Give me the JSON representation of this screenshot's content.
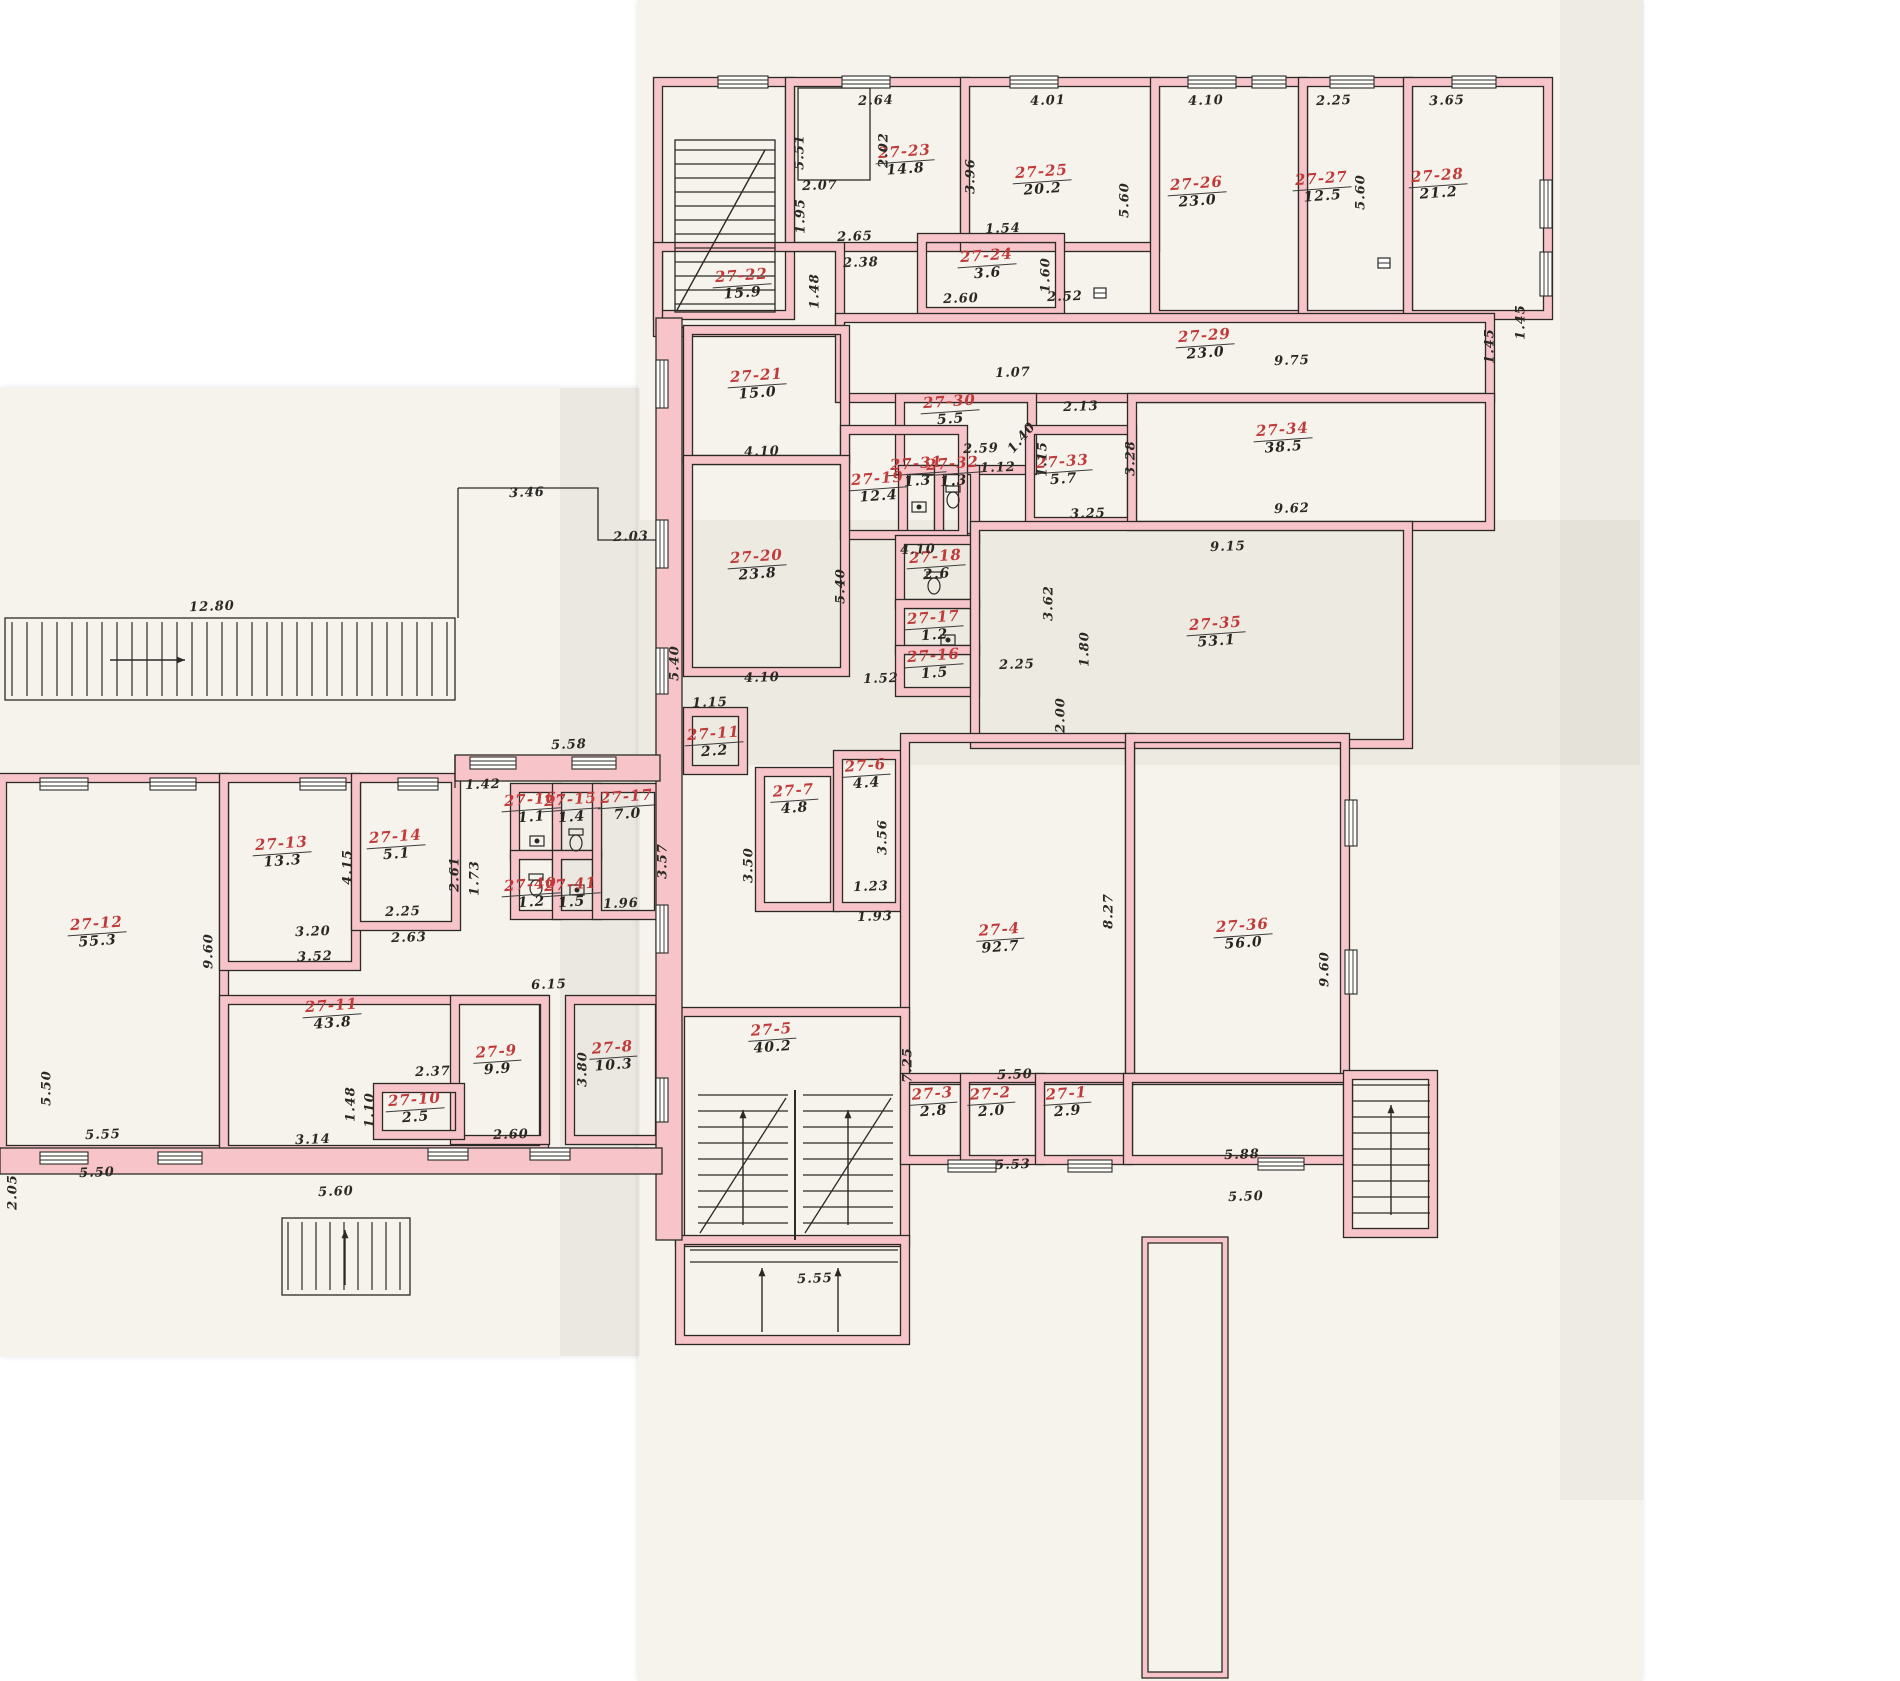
{
  "palette": {
    "paper": "#f6f3ec",
    "wall_pink": "#f6c4c9",
    "ink": "#2b2a26",
    "room_number_red": "#c13a3a"
  },
  "rooms": [
    {
      "id": "27-23",
      "area": "14.8",
      "x": 905,
      "y": 160
    },
    {
      "id": "27-25",
      "area": "20.2",
      "x": 1042,
      "y": 180
    },
    {
      "id": "27-26",
      "area": "23.0",
      "x": 1197,
      "y": 192
    },
    {
      "id": "27-27",
      "area": "12.5",
      "x": 1322,
      "y": 187
    },
    {
      "id": "27-28",
      "area": "21.2",
      "x": 1438,
      "y": 184
    },
    {
      "id": "27-22",
      "area": "15.9",
      "x": 742,
      "y": 284
    },
    {
      "id": "27-24",
      "area": "3.6",
      "x": 987,
      "y": 264
    },
    {
      "id": "27-29",
      "area": "23.0",
      "x": 1205,
      "y": 344
    },
    {
      "id": "27-21",
      "area": "15.0",
      "x": 757,
      "y": 384
    },
    {
      "id": "27-30",
      "area": "5.5",
      "x": 950,
      "y": 410
    },
    {
      "id": "27-31",
      "area": "1.3",
      "x": 917,
      "y": 472
    },
    {
      "id": "27-32",
      "area": "1.3",
      "x": 953,
      "y": 472
    },
    {
      "id": "27-33",
      "area": "5.7",
      "x": 1063,
      "y": 470
    },
    {
      "id": "27-34",
      "area": "38.5",
      "x": 1283,
      "y": 438
    },
    {
      "id": "27-19",
      "area": "12.4",
      "x": 878,
      "y": 487
    },
    {
      "id": "27-20",
      "area": "23.8",
      "x": 757,
      "y": 565
    },
    {
      "id": "27-18",
      "area": "2.6",
      "x": 936,
      "y": 565
    },
    {
      "id": "27-17",
      "area": "1.2",
      "x": 934,
      "y": 626
    },
    {
      "id": "27-16",
      "area": "1.5",
      "x": 934,
      "y": 664
    },
    {
      "id": "27-35",
      "area": "53.1",
      "x": 1216,
      "y": 632
    },
    {
      "id": "27-11",
      "area": "2.2",
      "x": 714,
      "y": 742
    },
    {
      "id": "27-6",
      "area": "4.4",
      "x": 866,
      "y": 774
    },
    {
      "id": "27-7",
      "area": "4.8",
      "x": 794,
      "y": 799
    },
    {
      "id": "27-4",
      "area": "92.7",
      "x": 1000,
      "y": 938
    },
    {
      "id": "27-36",
      "area": "56.0",
      "x": 1243,
      "y": 934
    },
    {
      "id": "27-5",
      "area": "40.2",
      "x": 772,
      "y": 1038
    },
    {
      "id": "27-3",
      "area": "2.8",
      "x": 933,
      "y": 1102
    },
    {
      "id": "27-2",
      "area": "2.0",
      "x": 991,
      "y": 1102
    },
    {
      "id": "27-1",
      "area": "2.9",
      "x": 1067,
      "y": 1102
    },
    {
      "id": "27-12",
      "area": "55.3",
      "x": 97,
      "y": 932
    },
    {
      "id": "27-13",
      "area": "13.3",
      "x": 282,
      "y": 852
    },
    {
      "id": "27-14",
      "area": "5.1",
      "x": 396,
      "y": 845
    },
    {
      "id": "27-16",
      "area": "1.1",
      "x": 531,
      "y": 808
    },
    {
      "id": "27-15",
      "area": "1.4",
      "x": 571,
      "y": 808
    },
    {
      "id": "27-17",
      "area": "7.0",
      "x": 627,
      "y": 805
    },
    {
      "id": "27-40",
      "area": "1.2",
      "x": 531,
      "y": 893
    },
    {
      "id": "27-41",
      "area": "1.5",
      "x": 571,
      "y": 893
    },
    {
      "id": "27-11",
      "area": "43.8",
      "x": 332,
      "y": 1014
    },
    {
      "id": "27-10",
      "area": "2.5",
      "x": 415,
      "y": 1108
    },
    {
      "id": "27-9",
      "area": "9.9",
      "x": 497,
      "y": 1060
    },
    {
      "id": "27-8",
      "area": "10.3",
      "x": 613,
      "y": 1056
    }
  ],
  "dimensions": [
    {
      "v": "5.51",
      "x": 800,
      "y": 152,
      "r": 90
    },
    {
      "v": "2.64",
      "x": 876,
      "y": 101,
      "r": 0
    },
    {
      "v": "2.02",
      "x": 884,
      "y": 150,
      "r": 90
    },
    {
      "v": "2.07",
      "x": 820,
      "y": 186,
      "r": 0
    },
    {
      "v": "1.95",
      "x": 801,
      "y": 216,
      "r": 90
    },
    {
      "v": "4.01",
      "x": 1048,
      "y": 101,
      "r": 0
    },
    {
      "v": "3.96",
      "x": 971,
      "y": 176,
      "r": 90
    },
    {
      "v": "5.60",
      "x": 1125,
      "y": 200,
      "r": 90
    },
    {
      "v": "4.10",
      "x": 1206,
      "y": 101,
      "r": 0
    },
    {
      "v": "2.25",
      "x": 1334,
      "y": 101,
      "r": 0
    },
    {
      "v": "5.60",
      "x": 1361,
      "y": 192,
      "r": 90
    },
    {
      "v": "3.65",
      "x": 1447,
      "y": 101,
      "r": 0
    },
    {
      "v": "1.45",
      "x": 1521,
      "y": 322,
      "r": 90
    },
    {
      "v": "2.65",
      "x": 855,
      "y": 237,
      "r": 0
    },
    {
      "v": "2.38",
      "x": 861,
      "y": 263,
      "r": 0
    },
    {
      "v": "1.48",
      "x": 815,
      "y": 291,
      "r": 90
    },
    {
      "v": "1.54",
      "x": 1003,
      "y": 229,
      "r": 0
    },
    {
      "v": "1.60",
      "x": 1046,
      "y": 275,
      "r": 90
    },
    {
      "v": "2.60",
      "x": 961,
      "y": 299,
      "r": 0
    },
    {
      "v": "2.52",
      "x": 1065,
      "y": 297,
      "r": 0
    },
    {
      "v": "9.75",
      "x": 1292,
      "y": 361,
      "r": 0
    },
    {
      "v": "1.45",
      "x": 1490,
      "y": 346,
      "r": 90
    },
    {
      "v": "4.10",
      "x": 762,
      "y": 452,
      "r": 0
    },
    {
      "v": "1.07",
      "x": 1013,
      "y": 373,
      "r": 0
    },
    {
      "v": "2.13",
      "x": 1081,
      "y": 407,
      "r": 0
    },
    {
      "v": "2.59",
      "x": 981,
      "y": 449,
      "r": 0
    },
    {
      "v": "1.12",
      "x": 998,
      "y": 468,
      "r": 0
    },
    {
      "v": "1.40",
      "x": 1022,
      "y": 438,
      "r": 50
    },
    {
      "v": "1.15",
      "x": 1043,
      "y": 459,
      "r": 90
    },
    {
      "v": "3.28",
      "x": 1131,
      "y": 458,
      "r": 90
    },
    {
      "v": "9.15",
      "x": 1228,
      "y": 547,
      "r": 0
    },
    {
      "v": "9.62",
      "x": 1292,
      "y": 509,
      "r": 0
    },
    {
      "v": "3.25",
      "x": 1088,
      "y": 514,
      "r": 0
    },
    {
      "v": "4.10",
      "x": 918,
      "y": 550,
      "r": 0
    },
    {
      "v": "5.40",
      "x": 841,
      "y": 586,
      "r": 90
    },
    {
      "v": "5.40",
      "x": 675,
      "y": 663,
      "r": 90
    },
    {
      "v": "1.52",
      "x": 881,
      "y": 679,
      "r": 0
    },
    {
      "v": "2.25",
      "x": 1017,
      "y": 665,
      "r": 0
    },
    {
      "v": "3.62",
      "x": 1049,
      "y": 603,
      "r": 90
    },
    {
      "v": "1.80",
      "x": 1085,
      "y": 649,
      "r": 90
    },
    {
      "v": "2.00",
      "x": 1061,
      "y": 715,
      "r": 90
    },
    {
      "v": "4.10",
      "x": 762,
      "y": 678,
      "r": 0
    },
    {
      "v": "1.15",
      "x": 710,
      "y": 703,
      "r": 0
    },
    {
      "v": "3.57",
      "x": 663,
      "y": 861,
      "r": 90
    },
    {
      "v": "3.50",
      "x": 749,
      "y": 865,
      "r": 90
    },
    {
      "v": "3.56",
      "x": 883,
      "y": 837,
      "r": 90
    },
    {
      "v": "1.23",
      "x": 871,
      "y": 887,
      "r": 0
    },
    {
      "v": "1.93",
      "x": 875,
      "y": 917,
      "r": 0
    },
    {
      "v": "7.25",
      "x": 908,
      "y": 1065,
      "r": 90
    },
    {
      "v": "8.27",
      "x": 1109,
      "y": 911,
      "r": 90
    },
    {
      "v": "9.60",
      "x": 1325,
      "y": 969,
      "r": 90
    },
    {
      "v": "5.50",
      "x": 1015,
      "y": 1075,
      "r": 0
    },
    {
      "v": "5.53",
      "x": 1013,
      "y": 1165,
      "r": 0
    },
    {
      "v": "5.88",
      "x": 1242,
      "y": 1155,
      "r": 0
    },
    {
      "v": "5.50",
      "x": 1246,
      "y": 1197,
      "r": 0
    },
    {
      "v": "5.55",
      "x": 815,
      "y": 1279,
      "r": 0
    },
    {
      "v": "12.80",
      "x": 212,
      "y": 607,
      "r": 0
    },
    {
      "v": "3.46",
      "x": 527,
      "y": 493,
      "r": 0
    },
    {
      "v": "2.03",
      "x": 631,
      "y": 537,
      "r": 0
    },
    {
      "v": "5.58",
      "x": 569,
      "y": 745,
      "r": 0
    },
    {
      "v": "1.42",
      "x": 483,
      "y": 785,
      "r": 0
    },
    {
      "v": "4.15",
      "x": 348,
      "y": 867,
      "r": 90
    },
    {
      "v": "2.61",
      "x": 455,
      "y": 874,
      "r": 90
    },
    {
      "v": "1.73",
      "x": 475,
      "y": 878,
      "r": 90
    },
    {
      "v": "2.25",
      "x": 403,
      "y": 912,
      "r": 0
    },
    {
      "v": "2.63",
      "x": 409,
      "y": 938,
      "r": 0
    },
    {
      "v": "3.20",
      "x": 313,
      "y": 932,
      "r": 0
    },
    {
      "v": "3.52",
      "x": 315,
      "y": 957,
      "r": 0
    },
    {
      "v": "9.60",
      "x": 209,
      "y": 951,
      "r": 90
    },
    {
      "v": "1.96",
      "x": 621,
      "y": 904,
      "r": 0
    },
    {
      "v": "6.15",
      "x": 549,
      "y": 985,
      "r": 0
    },
    {
      "v": "3.80",
      "x": 583,
      "y": 1069,
      "r": 90
    },
    {
      "v": "2.37",
      "x": 433,
      "y": 1072,
      "r": 0
    },
    {
      "v": "5.55",
      "x": 103,
      "y": 1135,
      "r": 0
    },
    {
      "v": "5.50",
      "x": 97,
      "y": 1173,
      "r": 0
    },
    {
      "v": "3.14",
      "x": 313,
      "y": 1140,
      "r": 0
    },
    {
      "v": "1.48",
      "x": 351,
      "y": 1104,
      "r": 90
    },
    {
      "v": "1.10",
      "x": 370,
      "y": 1110,
      "r": 90
    },
    {
      "v": "5.60",
      "x": 336,
      "y": 1192,
      "r": 0
    },
    {
      "v": "2.60",
      "x": 511,
      "y": 1135,
      "r": 0
    },
    {
      "v": "5.50",
      "x": 47,
      "y": 1088,
      "r": 90
    },
    {
      "v": "2.05",
      "x": 13,
      "y": 1192,
      "r": 90
    }
  ]
}
